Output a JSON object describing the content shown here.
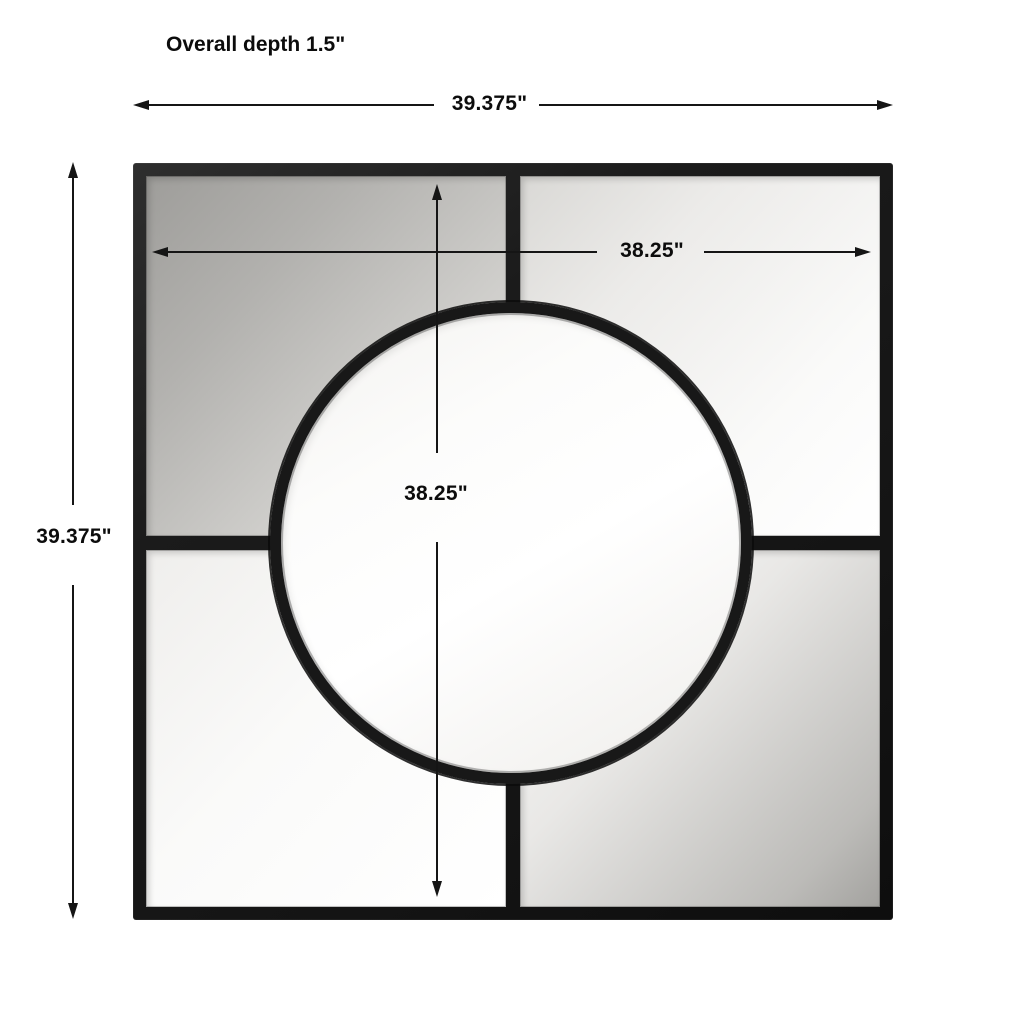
{
  "title": {
    "overall_depth": "Overall depth 1.5\""
  },
  "dimensions": {
    "outer_width": {
      "label": "39.375\"",
      "orientation": "horizontal",
      "measures": "full frame width"
    },
    "outer_height": {
      "label": "39.375\"",
      "orientation": "vertical",
      "measures": "full frame height"
    },
    "inner_width": {
      "label": "38.25\"",
      "orientation": "horizontal",
      "measures": "inner glass width"
    },
    "inner_height": {
      "label": "38.25\"",
      "orientation": "vertical",
      "measures": "inner glass height"
    }
  },
  "figure": {
    "description": "Square black metal-framed wall mirror divided into four panes by a cross mullion with a large circular pane in the center",
    "colors": {
      "background": "#ffffff",
      "frame": "#1b1b1b",
      "dimension_lines": "#151515",
      "text": "#0c0c0c",
      "glass_dark": "#a3a29f",
      "glass_light": "#ffffff"
    }
  }
}
